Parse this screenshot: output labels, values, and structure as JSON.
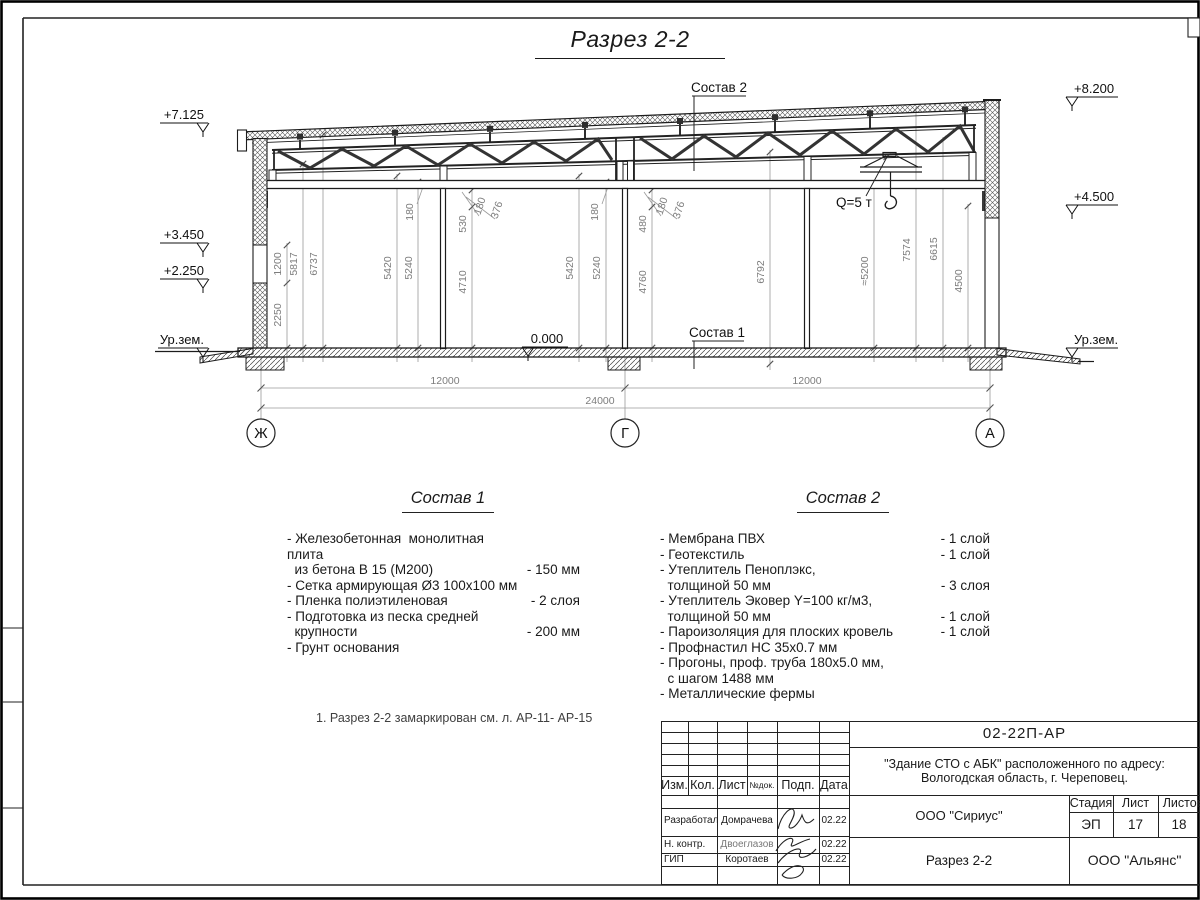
{
  "page": {
    "sheet_title": "Разрез 2-2",
    "note": "1. Разрез 2-2 замаркирован см. л. АР-11- АР-15"
  },
  "drawing": {
    "elevations": {
      "left": [
        "+7.125",
        "+3.450",
        "+2.250",
        "Ур.зем."
      ],
      "right": [
        "+8.200",
        "+4.500",
        "Ур.зем."
      ],
      "floor": "0.000"
    },
    "axis_bubbles": [
      "Ж",
      "Г",
      "А"
    ],
    "span_dims": {
      "left": "12000",
      "total": "24000",
      "right": "12000"
    },
    "vdims": {
      "wall_left": [
        "1200",
        "2250",
        "5817",
        "6737"
      ],
      "bay1": [
        "5420",
        "5240",
        "180",
        "530",
        "4710",
        "180",
        "376"
      ],
      "bay2": [
        "5420",
        "5240",
        "180",
        "480",
        "4760",
        "180",
        "376"
      ],
      "mid": "6792",
      "right": [
        "≈5200",
        "7574",
        "6615",
        "4500"
      ]
    },
    "labels": {
      "sostav2": "Состав 2",
      "sostav1": "Состав 1",
      "crane": "Q=5 т"
    }
  },
  "sostav1": {
    "title": "Состав 1",
    "items": [
      {
        "name": "- Железобетонная  монолитная плита\n  из бетона В 15 (М200)",
        "value": "- 150 мм"
      },
      {
        "name": "- Сетка армирующая Ø3 100х100 мм",
        "value": ""
      },
      {
        "name": "- Пленка полиэтиленовая",
        "value": "-  2 слоя"
      },
      {
        "name": "- Подготовка из песка средней\n  крупности",
        "value": "- 200 мм"
      },
      {
        "name": "- Грунт основания",
        "value": ""
      }
    ]
  },
  "sostav2": {
    "title": "Состав 2",
    "items": [
      {
        "name": "- Мембрана ПВХ",
        "value": "- 1 слой"
      },
      {
        "name": "- Геотекстиль",
        "value": "- 1 слой"
      },
      {
        "name": "- Утеплитель Пеноплэкс,\n  толщиной 50 мм",
        "value": "- 3 слоя"
      },
      {
        "name": "- Утеплитель Эковер Y=100 кг/м3,\n  толщиной 50 мм",
        "value": "- 1 слой"
      },
      {
        "name": "- Пароизоляция для плоских кровель",
        "value": "- 1 слой"
      },
      {
        "name": "- Профнастил НС 35х0.7 мм",
        "value": ""
      },
      {
        "name": "- Прогоны, проф. труба 180х5.0 мм,\n  с шагом 1488 мм",
        "value": ""
      },
      {
        "name": "- Металлические фермы",
        "value": ""
      }
    ]
  },
  "titleblock": {
    "doc_code": "02-22П-АР",
    "project": "\"Здание СТО с АБК\" расположенного по адресу:\nВологодская область, г. Череповец.",
    "columns": [
      "Изм.",
      "Кол.",
      "Лист",
      "№док.",
      "Подп.",
      "Дата"
    ],
    "rows": [
      {
        "role": "Разработал",
        "name": "Домрачева",
        "date": "02.22"
      },
      {
        "role": "Н. контр.",
        "name": "Двоеглазов",
        "date": "02.22"
      },
      {
        "role": "ГИП",
        "name": "Коротаев",
        "date": "02.22"
      }
    ],
    "org_design": "ООО \"Сириус\"",
    "stage_label": "Стадия",
    "sheet_label": "Лист",
    "sheets_label": "Листов",
    "stage": "ЭП",
    "sheet": "17",
    "sheets": "18",
    "section_name": "Разрез 2-2",
    "org_contractor": "ООО \"Альянс\""
  }
}
